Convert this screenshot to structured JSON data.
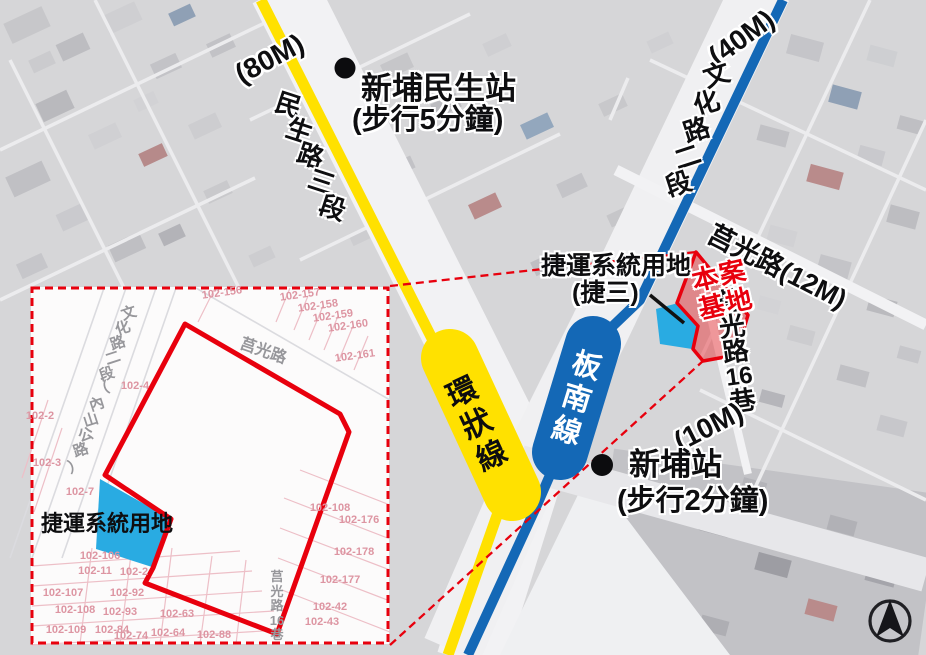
{
  "main": {
    "stations": [
      {
        "name": "新埔民生站",
        "walk": "(步行5分鐘)"
      },
      {
        "name": "新埔站",
        "walk": "(步行2分鐘)"
      }
    ],
    "metro_lines": [
      {
        "name": "環狀線",
        "chars": [
          "環",
          "狀",
          "線"
        ],
        "color": "#FFE100"
      },
      {
        "name": "板南線",
        "chars": [
          "板",
          "南",
          "線"
        ],
        "color": "#1468B6"
      }
    ],
    "roads": {
      "minsheng": {
        "width_label": "(80M)",
        "chars": [
          "民",
          "生",
          "路",
          "三",
          "段"
        ]
      },
      "wenhua": {
        "width_label": "(40M)",
        "chars": [
          "文",
          "化",
          "路",
          "二",
          "段"
        ]
      },
      "juguang": {
        "label": "莒光路(12M)"
      },
      "juguang16": {
        "chars": [
          "莒",
          "光",
          "路",
          "16",
          "巷"
        ],
        "width_label": "(10M)"
      }
    },
    "site": {
      "label_line1": "本案",
      "label_line2": "基地"
    },
    "mrt_land": {
      "line1": "捷運系統用地",
      "line2": "(捷三)"
    }
  },
  "inset": {
    "mrt_land_label": "捷運系統用地",
    "streets": {
      "wenhua_chars": [
        "文",
        "化",
        "路",
        "二",
        "段",
        "（",
        "內",
        "山",
        "公",
        "路",
        "）"
      ],
      "juguang": "莒光路",
      "juguang16_chars": [
        "莒",
        "光",
        "路",
        "16",
        "巷"
      ]
    },
    "lots": [
      "102-156",
      "102-157",
      "102-158",
      "102-159",
      "102-160",
      "102-161",
      "102-2",
      "102-3",
      "102-4",
      "102-7",
      "102-106",
      "102-11",
      "102-2",
      "102-107",
      "102-92",
      "102-108",
      "102-93",
      "102-63",
      "102-109",
      "102-84",
      "102-74",
      "102-64",
      "102-88",
      "102-108",
      "102-176",
      "102-178",
      "102-177",
      "102-42",
      "102-43"
    ]
  },
  "colors": {
    "circular_line_yellow": "#FFE100",
    "bannan_line_blue": "#1468B6",
    "site_red": "#E8000D",
    "mrt_land_cyan": "#29ABE2"
  }
}
